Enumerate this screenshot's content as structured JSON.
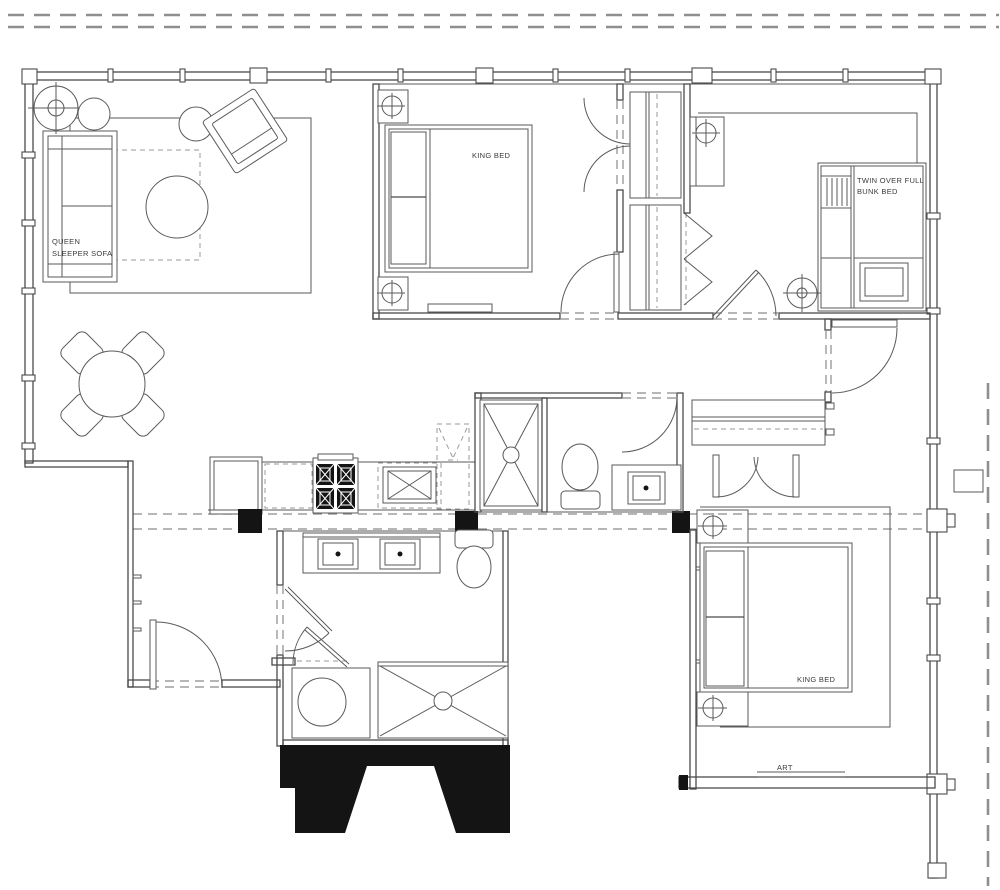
{
  "plan": {
    "colors": {
      "wall_line": "#4a4a4a",
      "furniture_line": "#5a5a5a",
      "text": "#3b3b3b",
      "solid_poche": "#141414",
      "dashed_line": "#8a8a8a",
      "background": "#ffffff"
    },
    "labels": {
      "living_sofa_line1": "QUEEN",
      "living_sofa_line2": "SLEEPER SOFA",
      "bedroom1_bed": "KING BED",
      "bunk_room_line1": "TWIN OVER FULL",
      "bunk_room_line2": "BUNK BED",
      "bedroom3_bed": "KING BED",
      "bedroom3_art": "ART"
    },
    "fixtures": [
      "floor-lamp",
      "side-table",
      "armchair",
      "coffee-table",
      "area-rug",
      "queen-sleeper-sofa",
      "dining-table",
      "dining-chair",
      "refrigerator",
      "cooktop",
      "kitchen-sink",
      "pantry-cabinet",
      "shower",
      "toilet",
      "vanity-sink",
      "double-vanity",
      "washer",
      "bunk-bed",
      "bunk-ladder",
      "desk",
      "nightstand",
      "table-lamp",
      "king-bed",
      "bench",
      "closet",
      "bifold-door",
      "double-door",
      "swing-door",
      "art-shelf",
      "window-mullion",
      "column"
    ]
  }
}
